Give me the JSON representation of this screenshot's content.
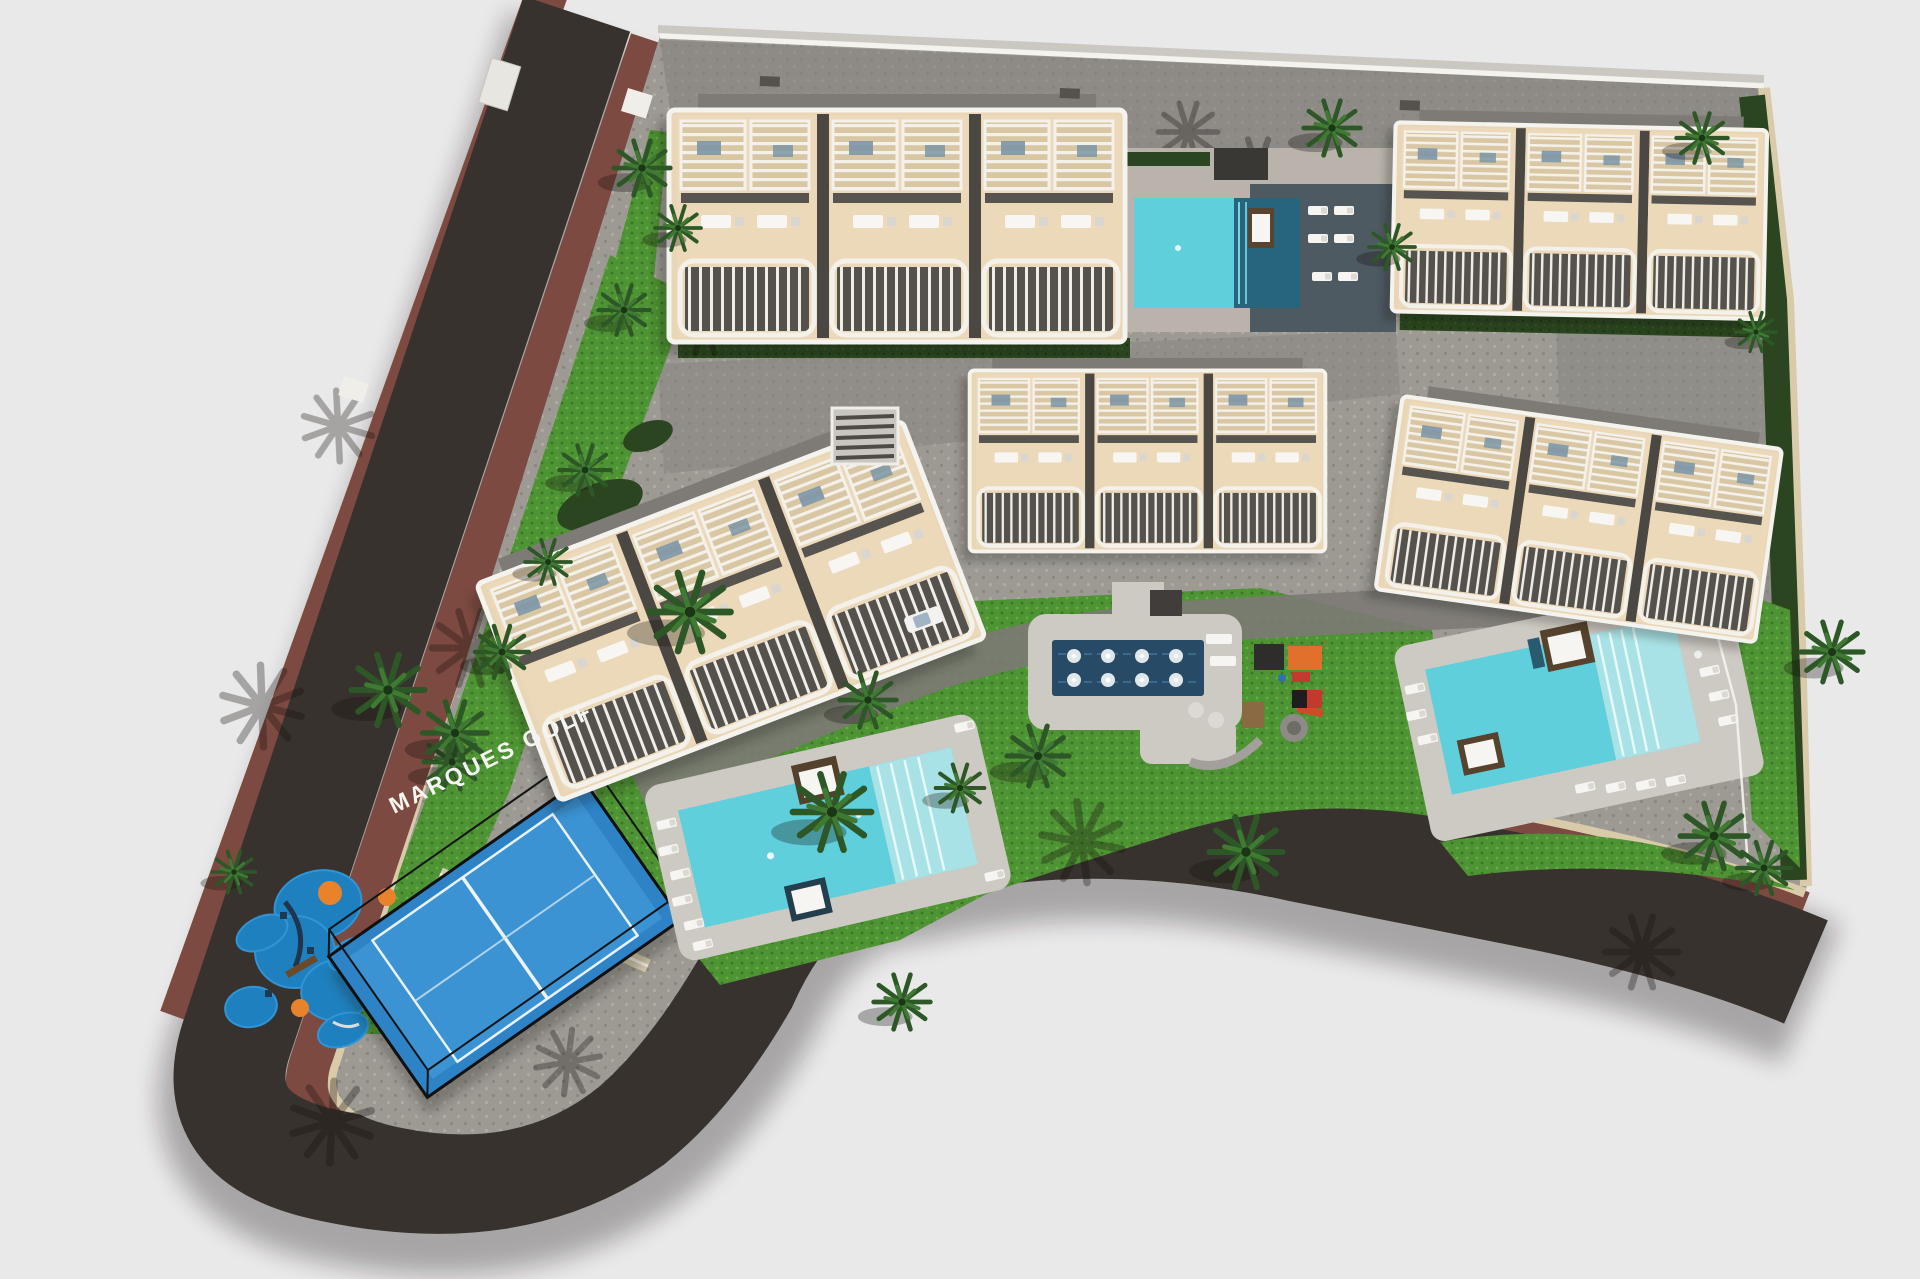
{
  "scene": {
    "description": "Aerial 3D site-plan rendering of a residential development",
    "development_label": "MARQUES GOLF",
    "background_color": "#e9e9ea"
  },
  "colors": {
    "bg": "#e9e9ea",
    "asphalt": "#37322d",
    "sidewalk": "#7c4a40",
    "curb": "#d9cbaa",
    "paver": "#9d9a94",
    "concrete": "#cdc9c3",
    "lawn": "#4e9334",
    "hedge": "#2a451f",
    "pool": "#5ecfdb",
    "pool-steps": "#a9e2e6",
    "pool-deep": "#27657f",
    "fountain": "#274a66",
    "court": "#2e83c6",
    "play": "#1f80bf",
    "bldg": "#e9d6b6",
    "bldg-dark": "#55514c",
    "white": "#f5f3ee",
    "roof": "#7e7b77",
    "shadow": "#16120e",
    "label": "#f4f4f0"
  },
  "site": {
    "buildings": [
      {
        "id": "building-block-1",
        "position": "top-left",
        "visible_units": 3
      },
      {
        "id": "building-block-2",
        "position": "top-right",
        "visible_units": 3
      },
      {
        "id": "building-block-3",
        "position": "middle-left-tilted",
        "visible_units": 3
      },
      {
        "id": "building-block-4",
        "position": "middle-center",
        "visible_units": 3
      },
      {
        "id": "building-block-5",
        "position": "middle-right-tilted",
        "visible_units": 3
      }
    ],
    "pools": [
      {
        "id": "pool-top-center",
        "type": "community pool with dark sun deck"
      },
      {
        "id": "pool-left-main",
        "type": "large pool with beach-entry steps"
      },
      {
        "id": "pool-right",
        "type": "community pool with beach-entry steps"
      },
      {
        "id": "fountain-plaza",
        "type": "ornamental water feature",
        "visible_jets": 8
      }
    ],
    "amenities": [
      {
        "id": "paddle-tennis-court",
        "surface": "blue with black fence"
      },
      {
        "id": "kids-playground-west",
        "surface": "blue rubber islands"
      },
      {
        "id": "kids-playground-east",
        "equipment": "slides, canopies, climbing frames"
      }
    ],
    "roads": [
      {
        "id": "street-west",
        "orientation": "diagonal"
      },
      {
        "id": "street-south",
        "orientation": "curved around site"
      }
    ]
  }
}
